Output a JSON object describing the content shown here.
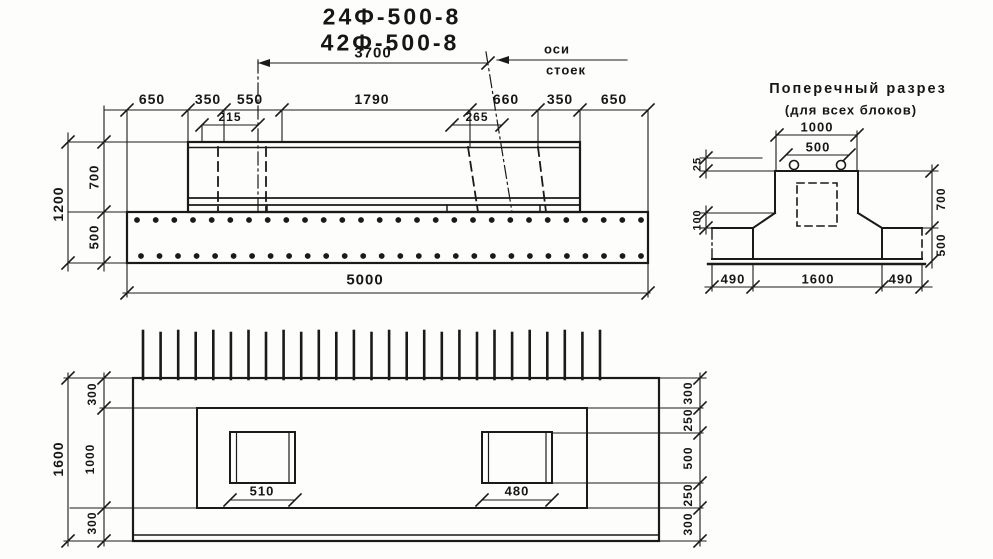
{
  "title": {
    "line1": "24Ф-500-8",
    "line2": "42Ф-500-8"
  },
  "elevation": {
    "dim_3700": "3700",
    "axis_label_line1": "оси",
    "axis_label_line2": "стоек",
    "dims_top_row": [
      "650",
      "350",
      "550",
      "1790",
      "660",
      "350",
      "650"
    ],
    "dim_215": "215",
    "dim_265": "265",
    "dim_left_total": "1200",
    "dim_left_upper": "700",
    "dim_left_lower": "500",
    "dim_bottom": "5000",
    "rebar_dot_rows": 2,
    "rebar_dots_per_row": 28
  },
  "section": {
    "title_line1": "Поперечный разрез",
    "title_line2": "(для всех  блоков)",
    "dim_top_outer": "1000",
    "dim_top_inner": "500",
    "dim_25": "25",
    "dim_100": "100",
    "dim_right_upper": "700",
    "dim_right_lower": "500",
    "dims_bottom": [
      "490",
      "1600",
      "490"
    ]
  },
  "plan": {
    "dim_left_total": "1600",
    "dims_left": [
      "300",
      "1000",
      "300"
    ],
    "dims_right": [
      "300",
      "250",
      "500",
      "250",
      "300"
    ],
    "dim_socket_left": "510",
    "dim_socket_right": "480",
    "spike_count": 27
  },
  "colors": {
    "ink": "#1a1a1a",
    "paper": "#fdfdfb"
  }
}
